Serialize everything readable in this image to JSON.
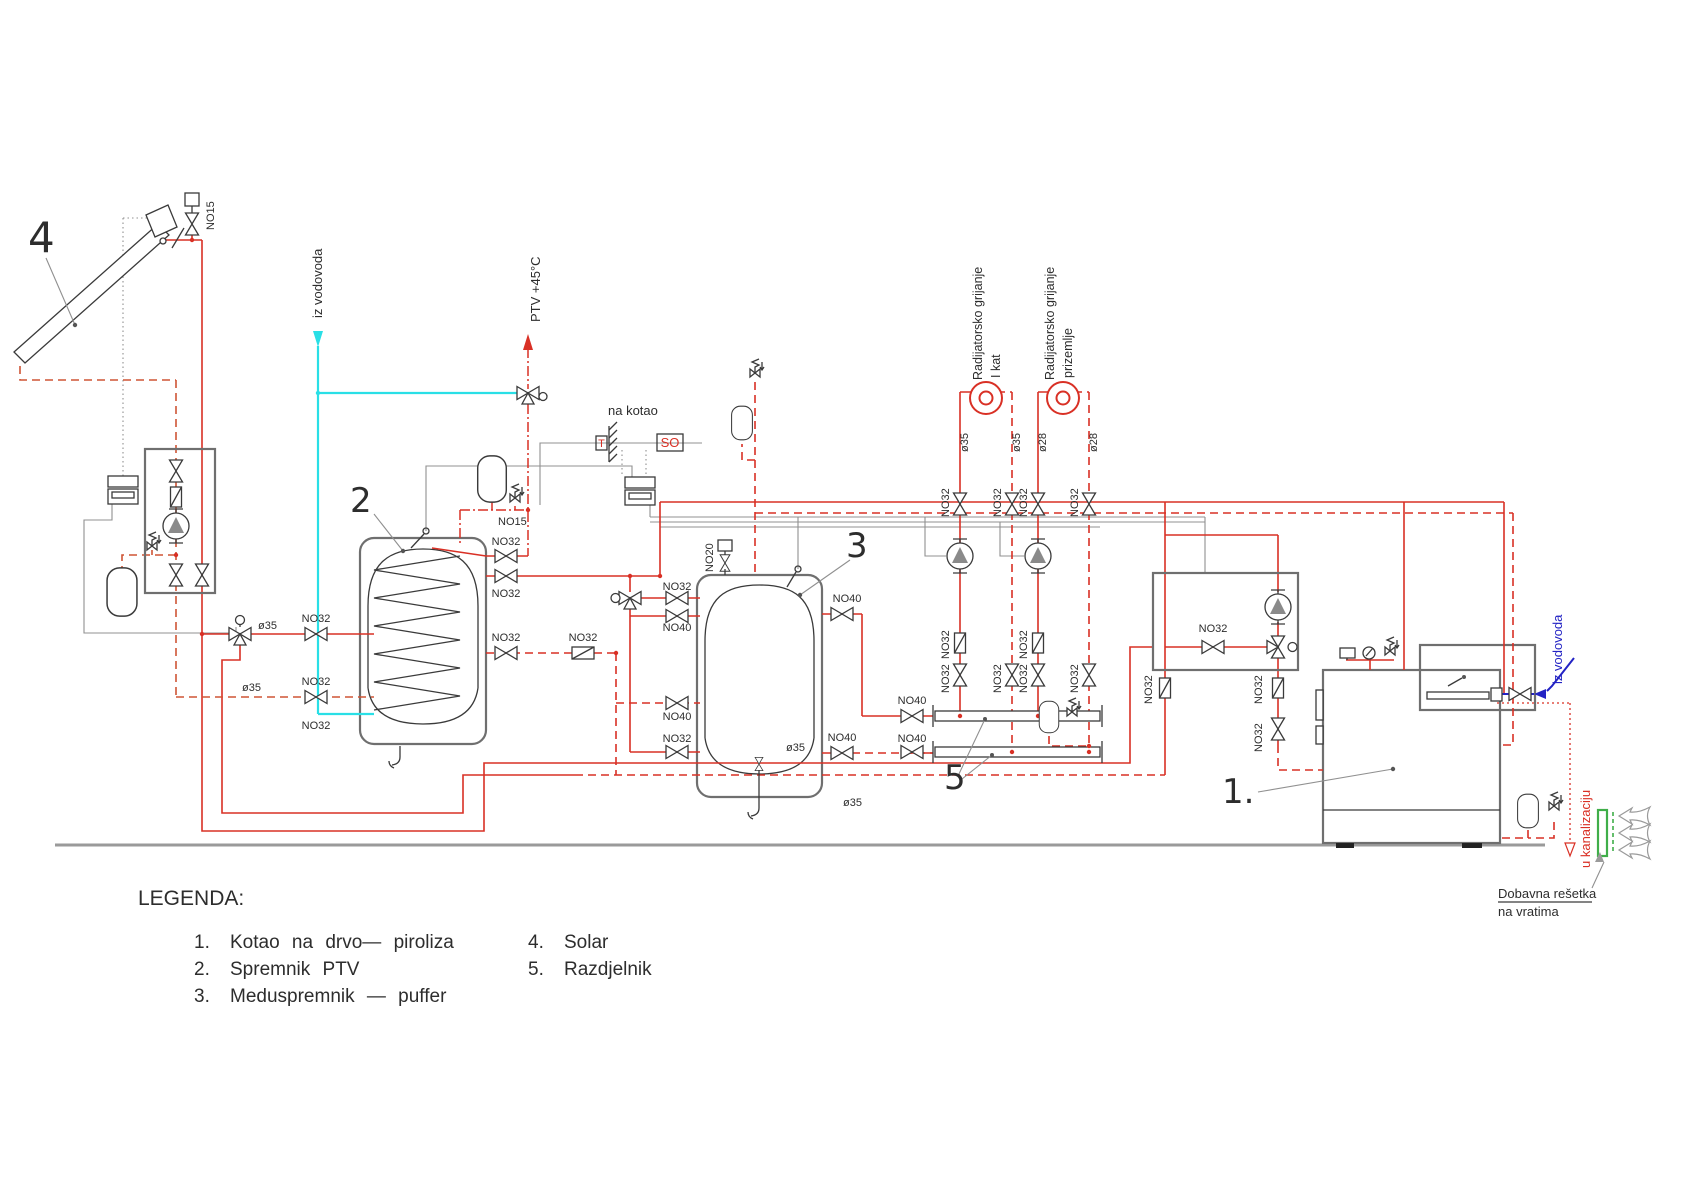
{
  "colors": {
    "red": "#d93025",
    "solar": "#cf5535",
    "cyan": "#29dfe6",
    "blue": "#2323c4",
    "green": "#3fae49",
    "wire": "#909090",
    "ink": "#2d2d2d",
    "ground": "#9a9a9a"
  },
  "numbers": {
    "boiler": "1.",
    "tank_ptv": "2",
    "puffer": "3",
    "solar": "4",
    "razdjelnik": "5"
  },
  "labels": {
    "iz_vodovoda_left": "iz vodovoda",
    "ptv_out": "PTV +45°C",
    "na_kotao": "na kotao",
    "so": "SO",
    "t_sensor": "T",
    "rad_kat_1": "Radijatorsko grijanje",
    "rad_kat_2": "I kat",
    "rad_priz_1": "Radijatorsko grijanje",
    "rad_priz_2": "prizemlje",
    "iz_vodovoda_right": "iz vodovoda",
    "u_kanalizaciju": "u kanalizaciju",
    "dobavna_1": "Dobavna rešetka",
    "dobavna_2": "na vratima"
  },
  "pipe_sizes": {
    "no15": "NO15",
    "no20": "NO20",
    "no32": "NO32",
    "no40": "NO40",
    "d35": "ø35",
    "d28": "ø28"
  },
  "legend": {
    "heading": "LEGENDA:",
    "left": [
      {
        "n": "1.",
        "t": "Kotao na drvo— piroliza"
      },
      {
        "n": "2.",
        "t": "Spremnik PTV"
      },
      {
        "n": "3.",
        "t": "Meduspremnik — puffer"
      }
    ],
    "right": [
      {
        "n": "4.",
        "t": "Solar"
      },
      {
        "n": "5.",
        "t": "Razdjelnik"
      }
    ]
  }
}
